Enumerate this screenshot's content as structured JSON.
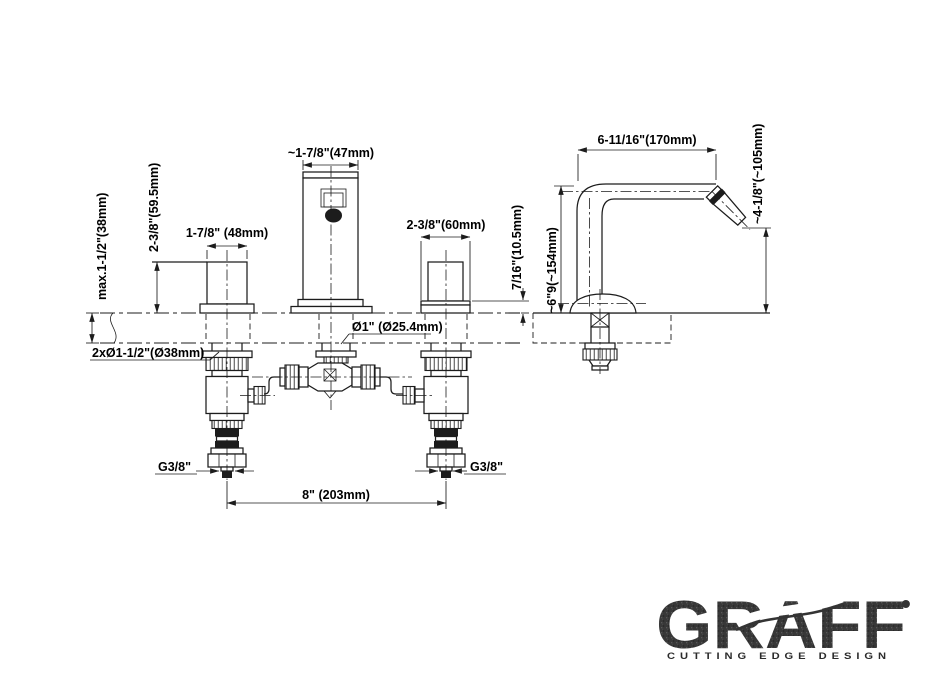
{
  "colors": {
    "line": "#1c1c1c",
    "logo": "#383838",
    "background": "#ffffff"
  },
  "dimensions": {
    "deck_max_thickness": "max.1-1/2\"(38mm)",
    "handle_height_above_deck": "2-3/8\"(59.5mm)",
    "left_handle_width": "1-7/8\" (48mm)",
    "spout_body_width": "~1-7/8\"(47mm)",
    "right_handle_base_width": "2-3/8\"(60mm)",
    "base_plate_height": "7/16\"(10.5mm)",
    "spout_hole_diameter": "Ø1\" (Ø25.4mm)",
    "handle_holes_diameter": "2xØ1-1/2\"(Ø38mm)",
    "supply_thread_left": "G3/8\"",
    "supply_thread_right": "G3/8\"",
    "handle_centers_distance": "8\" (203mm)",
    "spout_reach": "6-11/16\"(170mm)",
    "spout_height": "~6\"9(~154mm)",
    "spout_outlet_height": "~4-1/8\"(~105mm)"
  },
  "logo": {
    "brand": "GRAFF",
    "mark": "•",
    "tagline": "CUTTING EDGE DESIGN"
  }
}
